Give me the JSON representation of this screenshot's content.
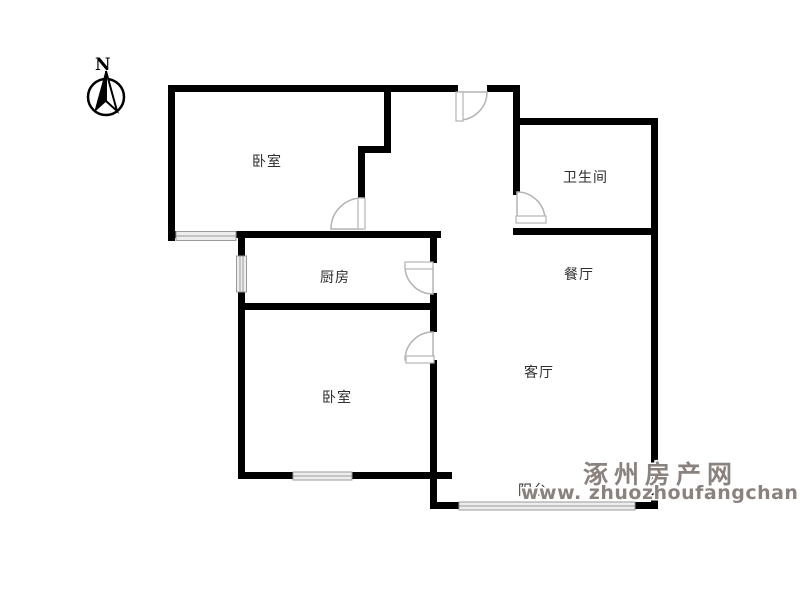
{
  "title": "户型图",
  "compass": {
    "label": "N"
  },
  "rooms": [
    {
      "id": "bedroom-top",
      "label": "卧室"
    },
    {
      "id": "bathroom",
      "label": "卫生间"
    },
    {
      "id": "kitchen",
      "label": "厨房"
    },
    {
      "id": "dining-room",
      "label": "餐厅"
    },
    {
      "id": "living-room",
      "label": "客厅"
    },
    {
      "id": "bedroom-bottom",
      "label": "卧室"
    },
    {
      "id": "balcony",
      "label": "阳台"
    }
  ],
  "watermark": {
    "site_name": "涿州房产网",
    "url": "www. zhuozhoufangchan. com",
    "color": "#8a827e"
  },
  "colors": {
    "wall": "#000000",
    "window_fill": "#ededed",
    "window_stroke": "#9a9a9a",
    "door_stroke": "#b3b3b3"
  }
}
